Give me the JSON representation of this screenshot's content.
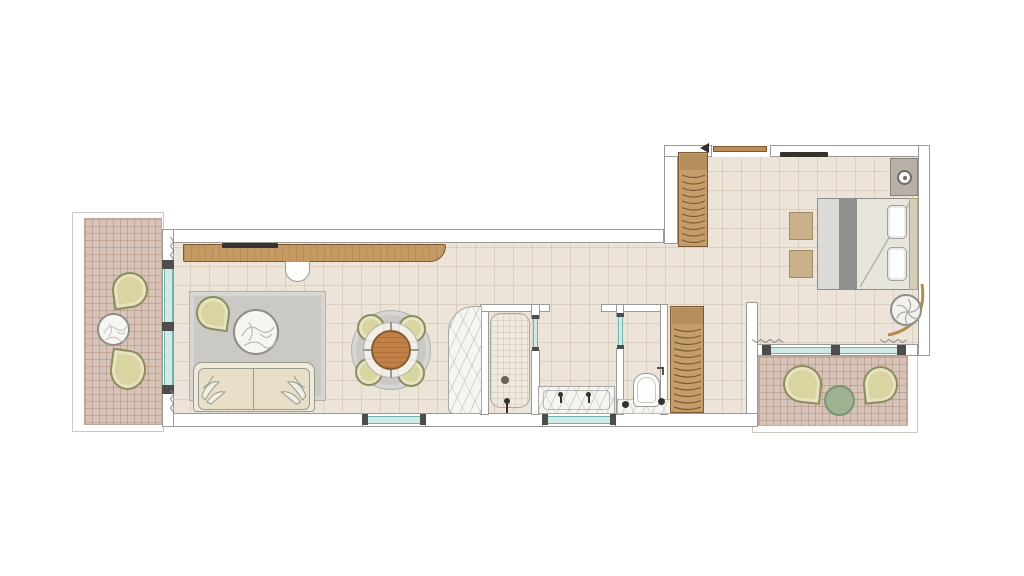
{
  "document": {
    "kind": "architectural floor plan",
    "title": "Suite floor plan"
  },
  "palette": {
    "wall_outline": "#9a9a96",
    "floor": "#ece4d9",
    "floor_grid": "rgba(176,155,128,0.28)",
    "terrace": "#d7c3b7",
    "terrace_grid": "rgba(150,115,95,0.35)",
    "terrace_edge": "#c2ab9d",
    "outline_faint": "#cdc9c2",
    "glass": "#cfe9e5",
    "glass_edge": "#6fb5ad",
    "mullion": "#4d4d4b",
    "wood": "#c49a62",
    "wood_door": "#b98e55",
    "wood_dark": "#7d5a33",
    "louver": "#c49e6a",
    "olive": "#d9d5a0",
    "olive_dark": "#8c8c60",
    "sage": "#9db290",
    "sage_dark": "#7d9472",
    "rug": "#cac9c4",
    "rug_edge": "#b2b1ac",
    "table_wood": "#c28046",
    "table_wood_dark": "#8a5c34",
    "marble": "#f6f5f1",
    "stone_edge": "#a9a7a1",
    "sofa": "#f0eadd",
    "cushion": "#e7dfc8",
    "sofa_edge": "#9a9a8c",
    "bed": "#dadad6",
    "bed_light": "#e8e5dc",
    "runner": "#8f8f8d",
    "pillow": "#fdfdfb",
    "headboard": "#d8cdb6",
    "bench": "#c8b18b",
    "nightstand": "#b6b0a6",
    "curtain": "#8a8a86",
    "dark": "#35322e",
    "plant_ring": "#8d8d89"
  },
  "rooms": {
    "terrace_left": {
      "label": "Terrace (west)",
      "furniture": [
        "lounge-chair",
        "round-side-table",
        "lounge-chair"
      ]
    },
    "living_room": {
      "label": "Living room",
      "furniture": [
        "console-with-tv",
        "desk-chair",
        "area-rug",
        "lounge-chair",
        "round-coffee-table",
        "sofa-with-pillows",
        "dining-table-for-four"
      ]
    },
    "shower_room": {
      "label": "Shower room",
      "furniture": [
        "shower-tray",
        "floor-drain",
        "shower-fixture",
        "stone-partition"
      ]
    },
    "vanity_nook": {
      "label": "Vanity nook",
      "furniture": [
        "double-vanity",
        "faucet",
        "faucet"
      ]
    },
    "wc": {
      "label": "WC",
      "furniture": [
        "toilet",
        "marble-mat",
        "paper-holder"
      ]
    },
    "hallway": {
      "label": "Hallway",
      "furniture": [
        "louvered-wardrobe",
        "louvered-wardrobe"
      ]
    },
    "bedroom": {
      "label": "Bedroom",
      "furniture": [
        "entry-door",
        "wall-tv",
        "double-bed",
        "bed-runner",
        "pillows",
        "bench",
        "bench",
        "nightstand-with-lamp",
        "potted-plant",
        "curved-curtain-rail"
      ]
    },
    "terrace_bottom": {
      "label": "Terrace (south)",
      "furniture": [
        "lounge-chair",
        "round-table",
        "lounge-chair"
      ]
    }
  },
  "openings": {
    "west_glass_wall": {
      "panes": 2,
      "mullions": 3
    },
    "south_window_living": 1,
    "south_window_vanity": 1,
    "bedroom_south_glass_wall": {
      "panes": 2,
      "mullions": 3
    },
    "shower_glass_door": 1,
    "wc_glass_door": 1,
    "entry_door": 1
  },
  "decor": {
    "curtain_marks": 4,
    "louver_panels": 2
  }
}
